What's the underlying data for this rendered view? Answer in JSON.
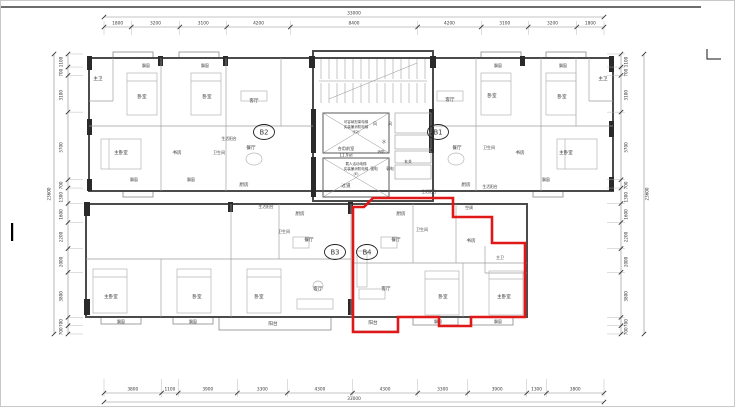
{
  "drawing": {
    "highlighted_unit": "B4",
    "highlight_color": "#e11818",
    "unit_labels": [
      {
        "label": "B2",
        "x": 263,
        "y": 131
      },
      {
        "label": "B1",
        "x": 437,
        "y": 131
      },
      {
        "label": "B3",
        "x": 334,
        "y": 251
      },
      {
        "label": "B4",
        "x": 366,
        "y": 251
      }
    ],
    "selected_outline_points": [
      [
        352,
        206
      ],
      [
        363,
        206
      ],
      [
        372,
        197
      ],
      [
        452,
        197
      ],
      [
        452,
        216
      ],
      [
        491,
        216
      ],
      [
        491,
        242
      ],
      [
        524,
        242
      ],
      [
        524,
        316
      ],
      [
        470,
        316
      ],
      [
        470,
        325
      ],
      [
        438,
        325
      ],
      [
        438,
        316
      ],
      [
        397,
        316
      ],
      [
        397,
        331
      ],
      [
        352,
        331
      ]
    ],
    "core": {
      "elevator_notes": [
        {
          "lines": [
            "可容纳担架电梯",
            "实装兼消防电梯",
            "(F2)"
          ],
          "x": 355,
          "y": 122
        },
        {
          "lines": [
            "载人活动电梯",
            "实装兼消防电梯",
            "(E)"
          ],
          "x": 355,
          "y": 164
        }
      ],
      "lobby_label": {
        "lines": [
          "合用前室",
          "11.9㎡"
        ],
        "x": 345,
        "y": 149
      }
    },
    "room_labels": [
      {
        "t": "主卫",
        "x": 97,
        "y": 79
      },
      {
        "t": "卧室",
        "x": 141,
        "y": 97
      },
      {
        "t": "卧室",
        "x": 206,
        "y": 97
      },
      {
        "t": "飘窗",
        "x": 145,
        "y": 66,
        "fs": 3.9
      },
      {
        "t": "飘窗",
        "x": 204,
        "y": 66,
        "fs": 3.9
      },
      {
        "t": "主卧室",
        "x": 120,
        "y": 153
      },
      {
        "t": "书房",
        "x": 176,
        "y": 153
      },
      {
        "t": "卫生间",
        "x": 218,
        "y": 153,
        "fs": 4
      },
      {
        "t": "飘窗",
        "x": 133,
        "y": 180,
        "fs": 3.9
      },
      {
        "t": "飘窗",
        "x": 190,
        "y": 180,
        "fs": 3.9
      },
      {
        "t": "生活阳台",
        "x": 228,
        "y": 139,
        "fs": 3.8
      },
      {
        "t": "客厅",
        "x": 253,
        "y": 101
      },
      {
        "t": "餐厅",
        "x": 250,
        "y": 148
      },
      {
        "t": "厨房",
        "x": 243,
        "y": 185
      },
      {
        "t": "风",
        "x": 374,
        "y": 124,
        "fs": 4
      },
      {
        "t": "风",
        "x": 389,
        "y": 124,
        "fs": 4
      },
      {
        "t": "水",
        "x": 383,
        "y": 142,
        "fs": 4
      },
      {
        "t": "消防",
        "x": 380,
        "y": 152,
        "fs": 3.6
      },
      {
        "t": "强电",
        "x": 373,
        "y": 169,
        "fs": 3.8
      },
      {
        "t": "弱电",
        "x": 389,
        "y": 169,
        "fs": 3.8
      },
      {
        "t": "过道",
        "x": 345,
        "y": 186
      },
      {
        "t": "客厅",
        "x": 449,
        "y": 100
      },
      {
        "t": "餐厅",
        "x": 456,
        "y": 148
      },
      {
        "t": "玄关",
        "x": 407,
        "y": 162,
        "fs": 3.9
      },
      {
        "t": "卧室",
        "x": 491,
        "y": 96
      },
      {
        "t": "卫生间",
        "x": 488,
        "y": 148,
        "fs": 4
      },
      {
        "t": "书房",
        "x": 519,
        "y": 153
      },
      {
        "t": "厨房",
        "x": 465,
        "y": 185
      },
      {
        "t": "生活阳台",
        "x": 489,
        "y": 187,
        "fs": 3.8
      },
      {
        "t": "卧室",
        "x": 561,
        "y": 97
      },
      {
        "t": "主卧室",
        "x": 565,
        "y": 153
      },
      {
        "t": "主卫",
        "x": 602,
        "y": 79
      },
      {
        "t": "飘窗",
        "x": 497,
        "y": 66,
        "fs": 3.9
      },
      {
        "t": "飘窗",
        "x": 562,
        "y": 66,
        "fs": 3.9
      },
      {
        "t": "飘窗",
        "x": 545,
        "y": 180,
        "fs": 3.9
      },
      {
        "t": "生活阳台",
        "x": 265,
        "y": 207,
        "fs": 3.8
      },
      {
        "t": "厨房",
        "x": 299,
        "y": 214
      },
      {
        "t": "卫生间",
        "x": 283,
        "y": 232,
        "fs": 4
      },
      {
        "t": "餐厅",
        "x": 308,
        "y": 240
      },
      {
        "t": "客厅",
        "x": 317,
        "y": 289
      },
      {
        "t": "主卧室",
        "x": 110,
        "y": 297
      },
      {
        "t": "卧室",
        "x": 196,
        "y": 297
      },
      {
        "t": "卧室",
        "x": 258,
        "y": 297
      },
      {
        "t": "阳台",
        "x": 272,
        "y": 324
      },
      {
        "t": "飘窗",
        "x": 120,
        "y": 322,
        "fs": 3.9
      },
      {
        "t": "飘窗",
        "x": 192,
        "y": 322,
        "fs": 3.9
      },
      {
        "t": "生活阳台",
        "x": 428,
        "y": 192,
        "fs": 3.8
      },
      {
        "t": "厨房",
        "x": 400,
        "y": 214
      },
      {
        "t": "空调",
        "x": 468,
        "y": 208,
        "fs": 3.9
      },
      {
        "t": "卫生间",
        "x": 421,
        "y": 230,
        "fs": 4
      },
      {
        "t": "餐厅",
        "x": 395,
        "y": 240
      },
      {
        "t": "书房",
        "x": 470,
        "y": 241
      },
      {
        "t": "主卫",
        "x": 499,
        "y": 258,
        "fs": 4
      },
      {
        "t": "客厅",
        "x": 385,
        "y": 289
      },
      {
        "t": "卧室",
        "x": 442,
        "y": 297
      },
      {
        "t": "主卧室",
        "x": 503,
        "y": 297
      },
      {
        "t": "阳台",
        "x": 372,
        "y": 323
      },
      {
        "t": "飘窗",
        "x": 437,
        "y": 322,
        "fs": 3.9
      },
      {
        "t": "飘窗",
        "x": 497,
        "y": 322,
        "fs": 3.9
      }
    ]
  },
  "dimensions": {
    "top": {
      "overall": "33000",
      "segments": [
        1800,
        3200,
        3100,
        4200,
        8400,
        4200,
        3100,
        3200,
        1800
      ]
    },
    "bottom": {
      "overall": "33000",
      "segments": [
        3800,
        1100,
        3900,
        3300,
        4300,
        4300,
        3300,
        3900,
        1300,
        3800
      ]
    },
    "left": {
      "overall": "23600",
      "segments": [
        1100,
        700,
        3100,
        5700,
        700,
        1300,
        1600,
        2200,
        2000,
        3800,
        700,
        700
      ]
    },
    "right": {
      "overall": "23600",
      "segments": [
        1100,
        700,
        3100,
        5700,
        700,
        1300,
        1600,
        2200,
        2000,
        3800,
        700,
        700
      ]
    }
  }
}
